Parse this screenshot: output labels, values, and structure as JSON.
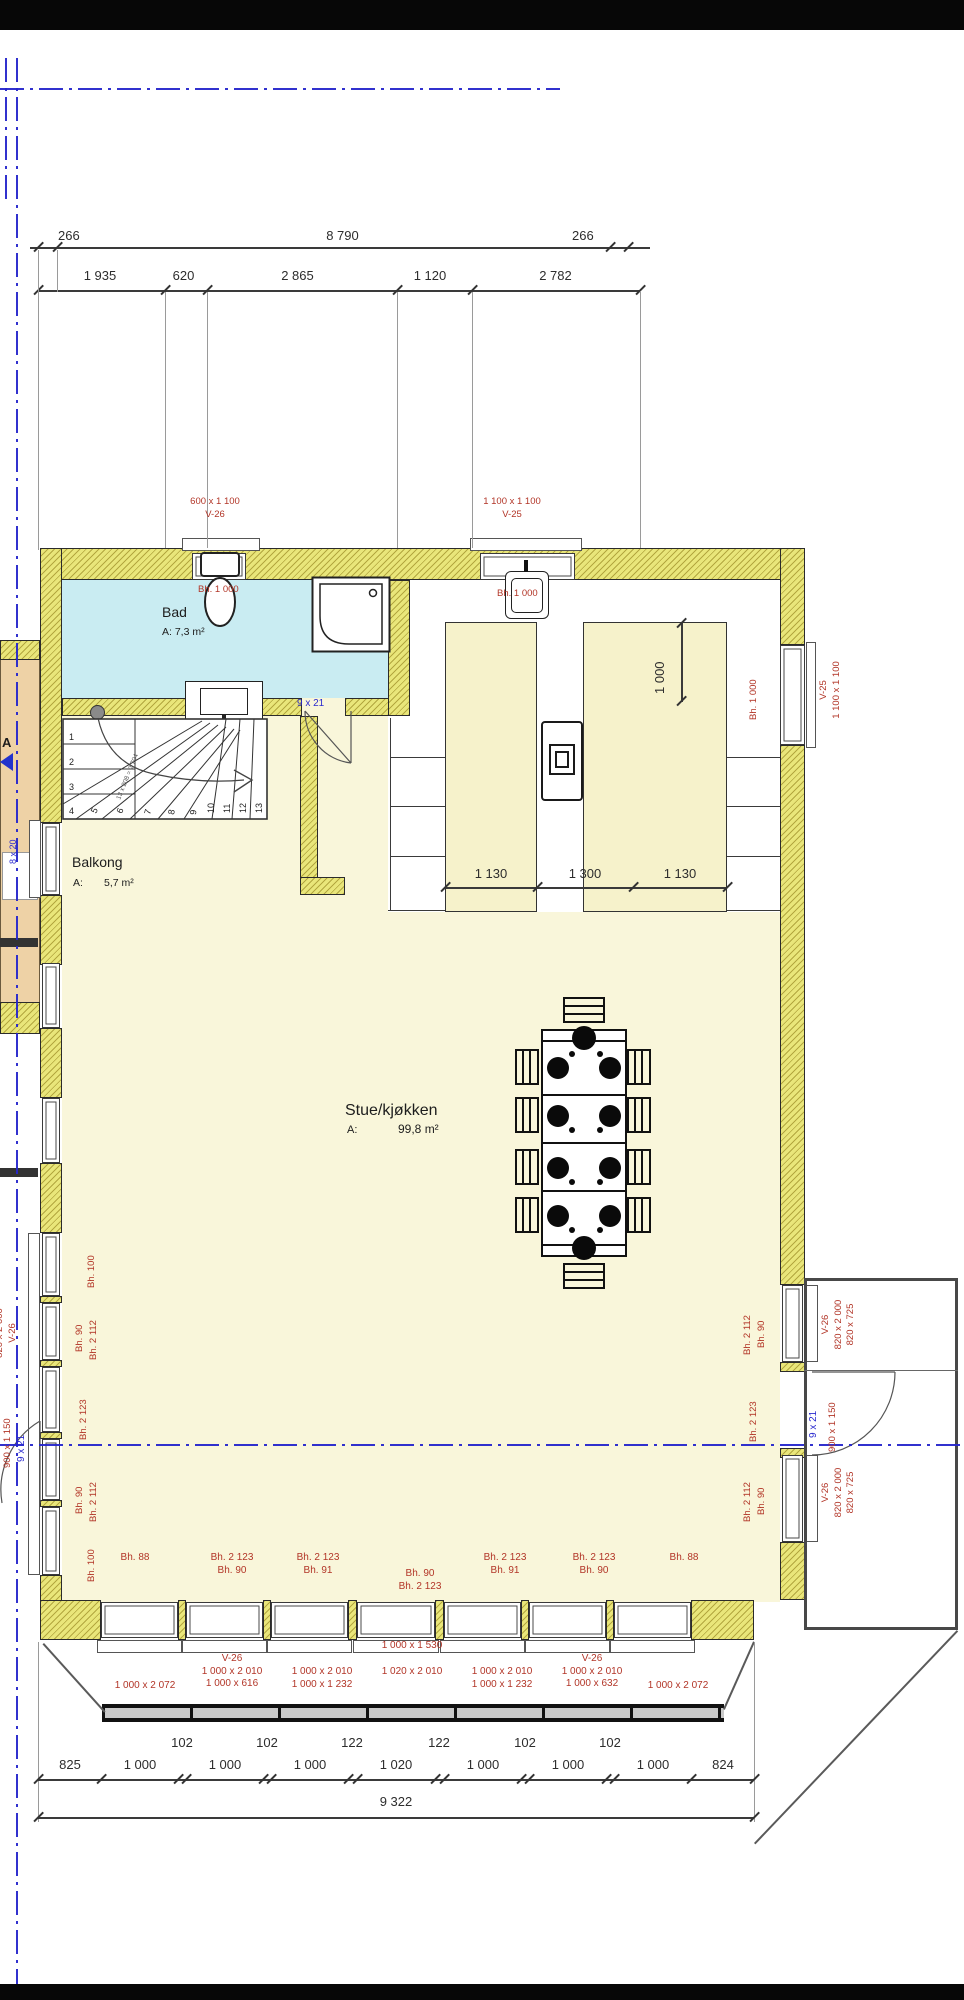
{
  "top_dims": {
    "row1": [
      "266",
      "8 790",
      "266"
    ],
    "row2": [
      "1 935",
      "620",
      "2 865",
      "1 120",
      "2 782"
    ]
  },
  "top_windows": [
    {
      "size": "600 x 1 100",
      "code": "V-26",
      "bh": "Bh. 1 000"
    },
    {
      "size": "1 100 x 1 100",
      "code": "V-25",
      "bh": "Bh. 1 000"
    }
  ],
  "right_top": {
    "bh": "Bh. 1 000",
    "code": "V-25",
    "size": "1 100 x 1 100"
  },
  "island": {
    "vdim": "1 000",
    "cols": [
      "1 130",
      "1 300",
      "1 130"
    ]
  },
  "rooms": {
    "bad": {
      "name": "Bad",
      "area": "A: 7,3 m²"
    },
    "balkong": {
      "name": "Balkong",
      "a": "A:",
      "area": "5,7 m²"
    },
    "stue": {
      "name": "Stue/kjøkken",
      "a": "A:",
      "area": "99,8 m²"
    }
  },
  "stair": {
    "numbers": [
      "1",
      "2",
      "3",
      "4",
      "5",
      "6",
      "7",
      "8",
      "9",
      "10",
      "11",
      "12",
      "13"
    ],
    "formula": "13 x 208 = 2 704"
  },
  "doors": {
    "bad": "9 x 21",
    "right_blue": "9 x 21",
    "right_size": "900 x 1 150",
    "left_blue": "9 x 21",
    "left_size": "900 x 1 150",
    "balcony": "8 x 20"
  },
  "left_wall": {
    "labels": [
      "Bh. 100",
      "Bh. 90",
      "Bh. 2 112",
      "Bh. 2 123",
      "Bh. 90",
      "Bh. 2 112",
      "Bh. 100"
    ],
    "out": [
      "820 x 2 000",
      "V-26"
    ]
  },
  "right_wall": {
    "labels": [
      "Bh. 2 112",
      "Bh. 90",
      "Bh. 2 123",
      "Bh. 2 112",
      "Bh. 90"
    ],
    "out0": [
      "V-26",
      "820 x 2 000",
      "820 x 725"
    ],
    "out1": [
      "V-26",
      "820 x 2 000",
      "820 x 725"
    ]
  },
  "bottom_bh": [
    [
      "Bh. 88"
    ],
    [
      "Bh. 2 123",
      "Bh. 90"
    ],
    [
      "Bh. 2 123",
      "Bh. 91"
    ],
    [
      "Bh. 90",
      "Bh. 2 123"
    ],
    [
      "Bh. 2 123",
      "Bh. 91"
    ],
    [
      "Bh. 2 123",
      "Bh. 90"
    ],
    [
      "Bh. 88"
    ]
  ],
  "bottom_windows": [
    [
      "1 000 x 2 072"
    ],
    [
      "V-26",
      "1 000 x 2 010",
      "1 000 x 616"
    ],
    [
      "1 000 x 2 010",
      "1 000 x 1 232"
    ],
    [
      "1 000 x 1 530",
      "1 020 x 2 010"
    ],
    [
      "1 000 x 2 010",
      "1 000 x 1 232"
    ],
    [
      "V-26",
      "1 000 x 2 010",
      "1 000 x 632"
    ],
    [
      "1 000 x 2 072"
    ]
  ],
  "bottom_dims": {
    "small": [
      "102",
      "102",
      "122",
      "122",
      "102",
      "102"
    ],
    "main": [
      "825",
      "1 000",
      "1 000",
      "1 000",
      "1 020",
      "1 000",
      "1 000",
      "1 000",
      "824"
    ],
    "total": "9 322"
  },
  "marker": "A"
}
